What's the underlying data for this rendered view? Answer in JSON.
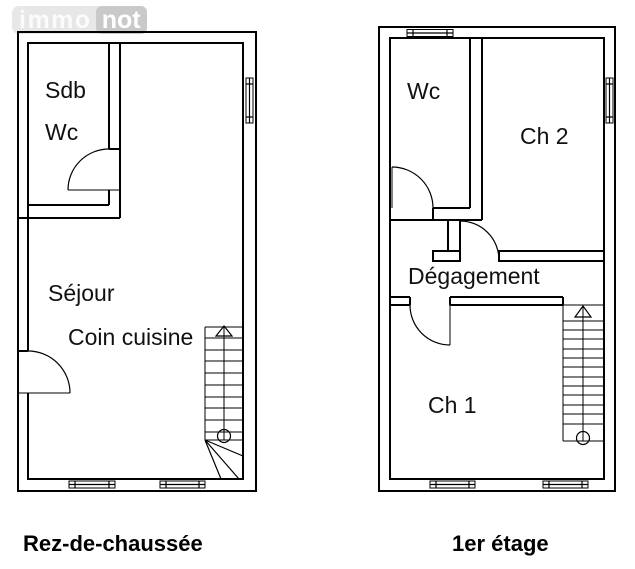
{
  "logo": {
    "immo": "immo",
    "not": "not"
  },
  "plans": [
    {
      "caption": "Rez-de-chaussée",
      "rooms": [
        {
          "label": "Sdb"
        },
        {
          "label": "Wc"
        },
        {
          "label": "Séjour"
        },
        {
          "label": "Coin cuisine"
        }
      ]
    },
    {
      "caption": "1er étage",
      "rooms": [
        {
          "label": "Wc"
        },
        {
          "label": "Ch 2"
        },
        {
          "label": "Dégagement"
        },
        {
          "label": "Ch 1"
        }
      ]
    }
  ],
  "colors": {
    "plan_line": "#000000",
    "label_text": "#111111",
    "logo_band": "#e7e7e7",
    "logo_immo_text": "#fbfbfb",
    "logo_not_bg": "#c9c9c9",
    "logo_not_text": "#ffffff"
  }
}
